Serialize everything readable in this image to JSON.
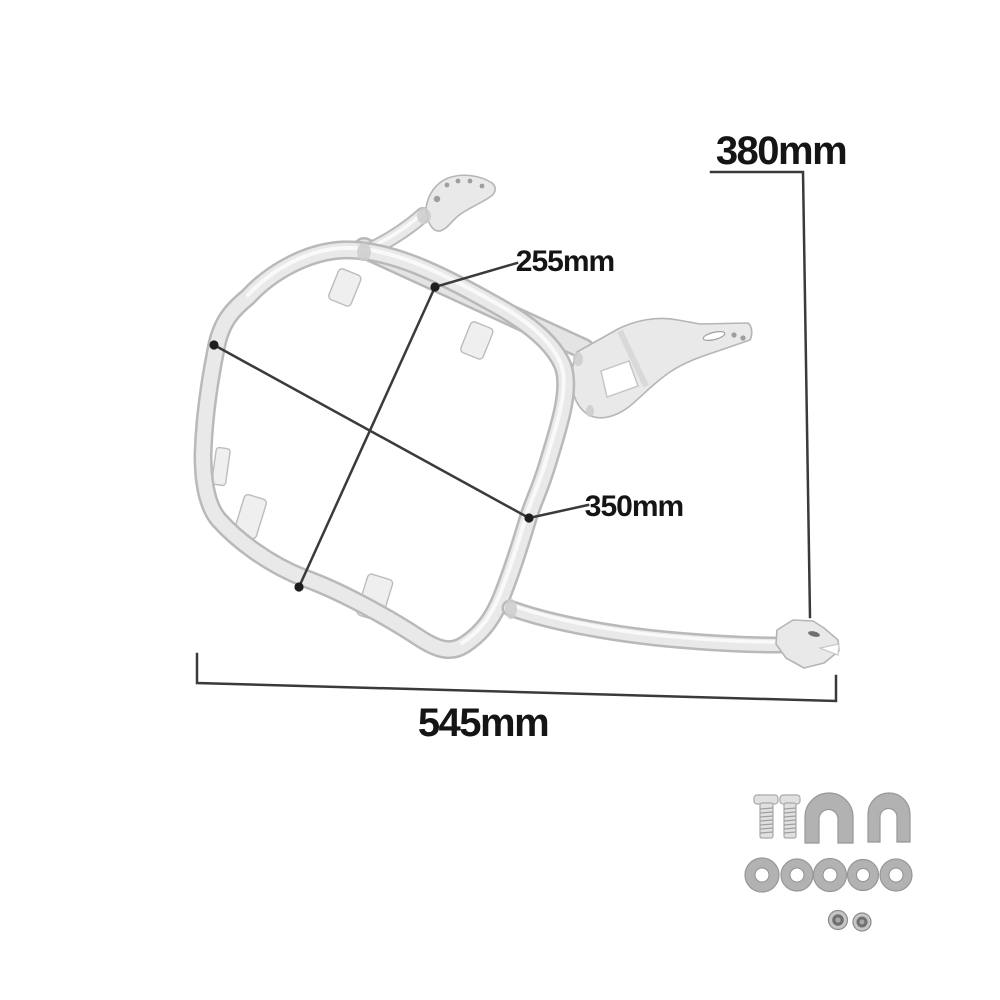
{
  "labels": {
    "height": "380mm",
    "diagonal_inner": "255mm",
    "diagonal_outer": "350mm",
    "width": "545mm"
  },
  "figure": {
    "name": "motorcycle pannier rack bracket with mounting hardware",
    "hardware_counts": {
      "bolts": 2,
      "u_brackets": 2,
      "washers": 5,
      "nuts": 2
    }
  },
  "colors": {
    "background": "#ffffff",
    "dimension_line": "#3a3a3a",
    "label_text": "#151515",
    "metal_edge": "#b9b9b9",
    "metal_body": "#e9e9e9",
    "metal_highlight": "#fbfbfb",
    "hardware_gray": "#b2b2b2"
  }
}
